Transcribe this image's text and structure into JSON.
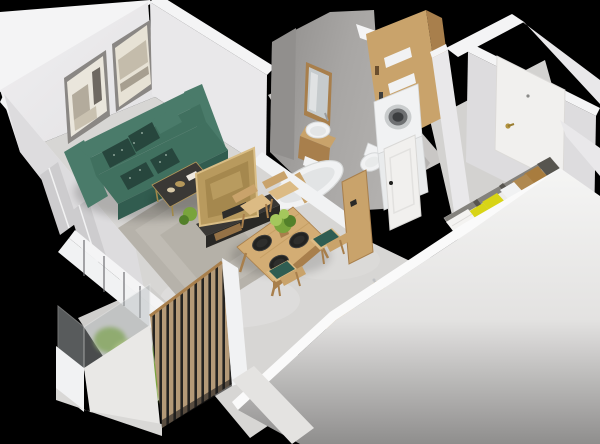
{
  "canvas": {
    "width": 600,
    "height": 444
  },
  "palette": {
    "bg": "#000000",
    "wall_bright": "#f4f4f5",
    "wall_light": "#e9e8ea",
    "wall_mid": "#dddcde",
    "wall_shade": "#cdccce",
    "floor_main": "#d7d6d4",
    "floor_bath": "#c9c7c5",
    "floor_hall": "#d3d2d0",
    "rug": "#b6b2aa",
    "concrete_wall": "#a5a3a1",
    "concrete_dark": "#918f8d",
    "sofa": "#40705f",
    "sofa_dark": "#315c4f",
    "sofa_light": "#4a7b6a",
    "cushion_dark": "#27463d",
    "chair_teal": "#2f5d52",
    "wood": "#c9a36b",
    "wood_dark": "#a87f4c",
    "wood_light": "#dcbb84",
    "counter_wood": "#d3ad74",
    "gold": "#b5975a",
    "tv_back": "#b89a5e",
    "tv_frame": "#d9bd85",
    "dark_furniture": "#3a3835",
    "darker_furniture": "#292825",
    "white_obj": "#f1f2f3",
    "white_shade": "#dcdedf",
    "steel": "#8f9193",
    "black_obj": "#1e1e1c",
    "plate": "#232321",
    "plant_green": "#79a43c",
    "plant_light": "#a4c75c",
    "plant_dark": "#53802a",
    "glass": "#b0b6b8",
    "yellow_pillow": "#d8d416",
    "yellow_dark": "#b5b20c",
    "tan_pillow": "#a87c3e",
    "tan_dark": "#8a6127",
    "bed_white": "#edecea",
    "bed_frame": "#57554f",
    "door_white": "#f1f0ee",
    "handle_gold": "#b29340",
    "washer_door": "#6e7072",
    "washer_rim": "#c9cccd",
    "slat_wood": "#b49a78",
    "slat_gap": "#242321"
  },
  "scene": {
    "type": "isometric-apartment-floorplan-render",
    "rooms": [
      {
        "name": "living-room",
        "objects": [
          "sofa",
          "patterned-cushions",
          "artwork-frame-1",
          "artwork-frame-2",
          "coffee-table",
          "rug",
          "tv",
          "tv-stand",
          "window-wall"
        ]
      },
      {
        "name": "dining-area",
        "objects": [
          "dining-table",
          "dining-chairs",
          "black-plates",
          "centerpiece-plant"
        ]
      },
      {
        "name": "kitchen",
        "objects": [
          "cooktop",
          "wood-countertop",
          "sink",
          "gray-cabinet"
        ]
      },
      {
        "name": "bathroom",
        "objects": [
          "mirror",
          "vanity-sink",
          "bathtub",
          "toilet",
          "laundry-cabinet",
          "washing-machine",
          "dryer",
          "bathroom-door",
          "closet-door"
        ]
      },
      {
        "name": "entry-hall",
        "objects": [
          "front-door",
          "door-handle"
        ]
      },
      {
        "name": "sleeping-nook",
        "objects": [
          "bed",
          "yellow-pillows",
          "tan-pillows",
          "white-pillows",
          "duvet"
        ]
      },
      {
        "name": "balcony",
        "objects": [
          "glass-balustrade",
          "plants",
          "wood-slat-screen",
          "parapet"
        ]
      }
    ]
  }
}
